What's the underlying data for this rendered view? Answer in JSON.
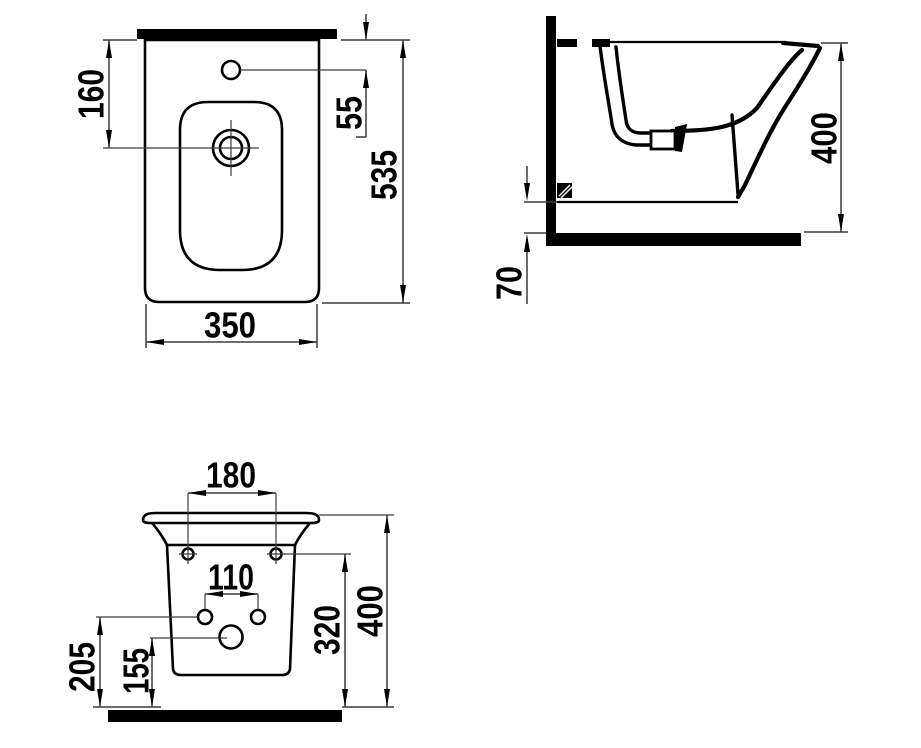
{
  "drawing": {
    "plan_view": {
      "drain_offset": "160",
      "faucet_offset": "55",
      "depth": "535",
      "width": "350"
    },
    "side_view": {
      "rim_height": "400",
      "floor_clearance": "70"
    },
    "front_view": {
      "wall_hole_spacing": "180",
      "anchor_hole_spacing": "110",
      "wall_hole_height": "320",
      "overall_height": "400",
      "anchor_hole_height": "205",
      "drain_hole_height": "155"
    }
  },
  "colors": {
    "ink": "#000000",
    "dim_line": "#3c3c3c",
    "background": "#ffffff"
  }
}
